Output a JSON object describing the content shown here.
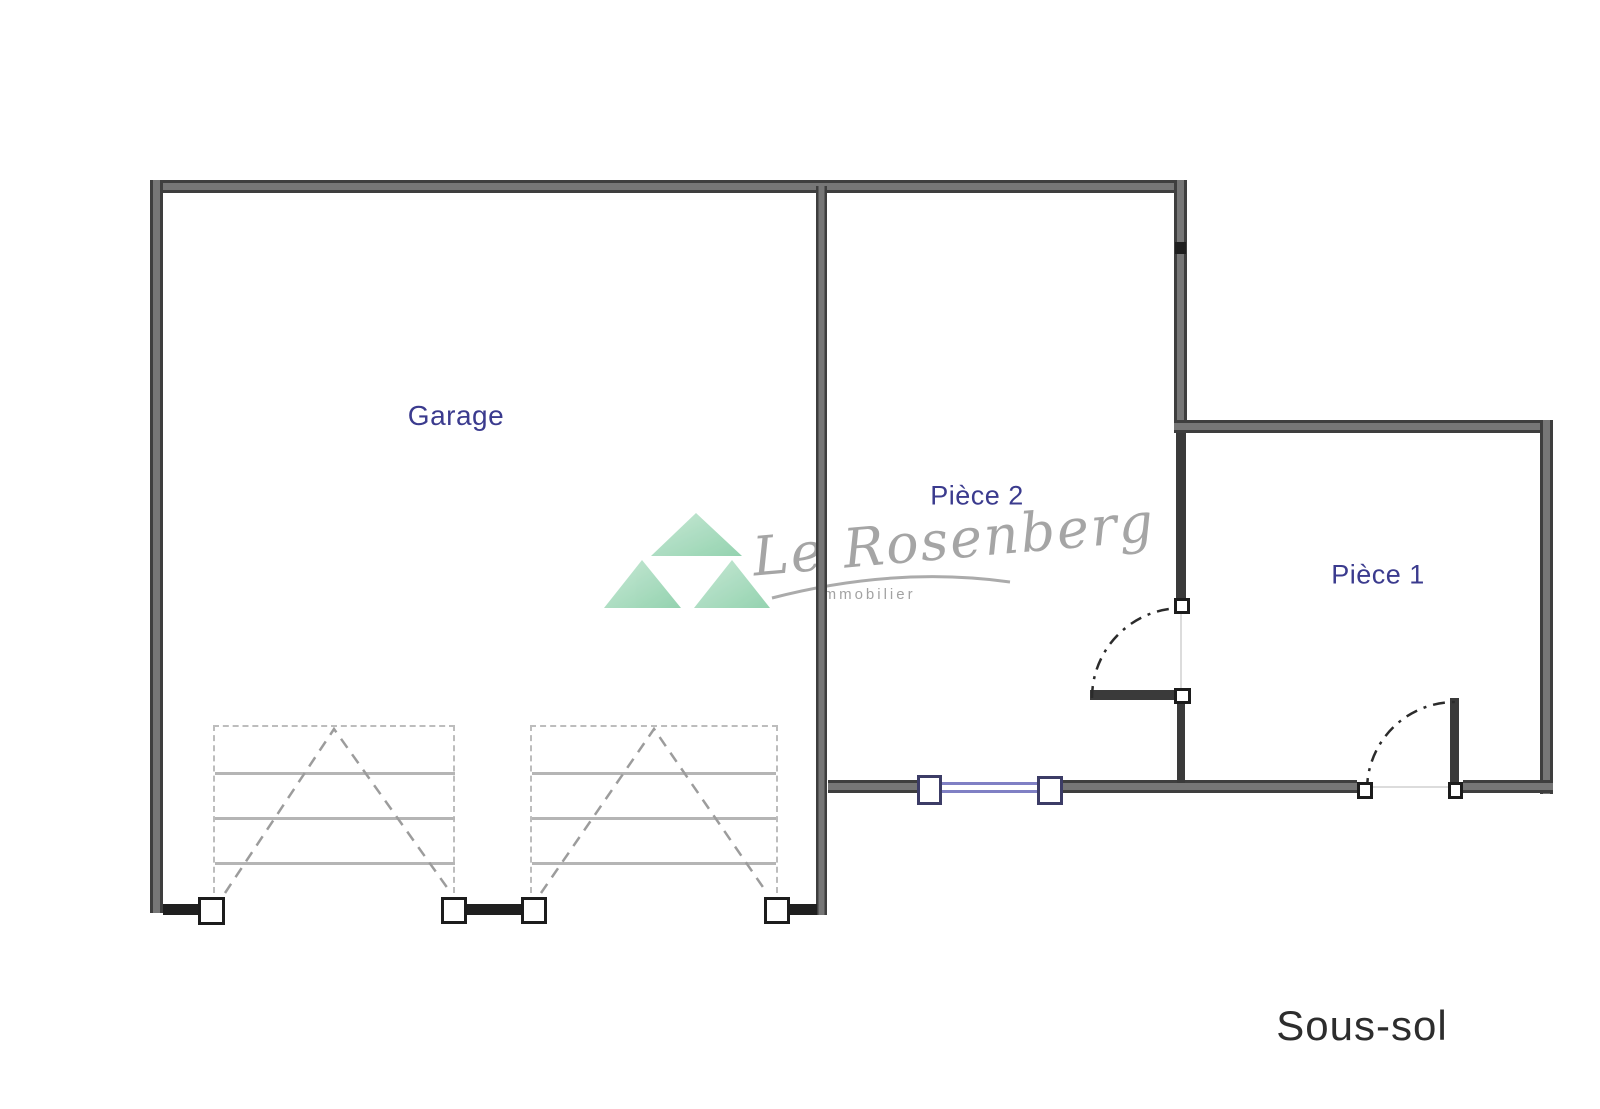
{
  "plan": {
    "rooms": [
      {
        "id": "garage",
        "label": "Garage"
      },
      {
        "id": "piece2",
        "label": "Pièce 2"
      },
      {
        "id": "piece1",
        "label": "Pièce 1"
      }
    ],
    "floor_label": "Sous-sol"
  },
  "watermark": {
    "brand": "Le Rosenberg",
    "subtitle": "Immobilier"
  },
  "colors": {
    "wall": "#4a4a4a",
    "room_label": "#3b3b8e",
    "window_frame": "#3c3c66",
    "window_glazing": "#8080c4",
    "watermark_green": "#8bcfa9",
    "watermark_gray": "#9e9e9e",
    "floor_label": "#2d2d2d"
  }
}
